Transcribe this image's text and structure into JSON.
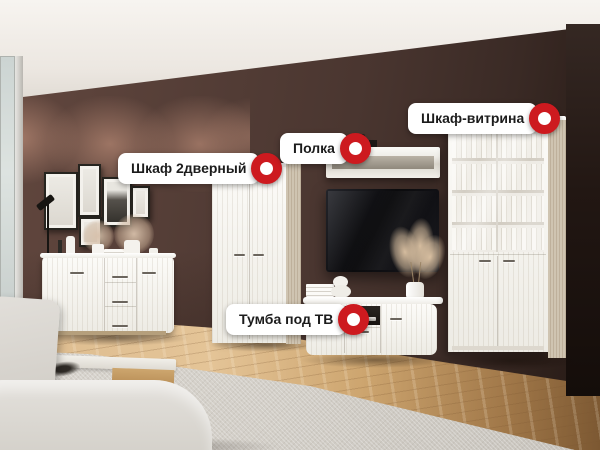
{
  "callouts": [
    {
      "id": "wardrobe-2door",
      "label": "Шкаф 2дверный"
    },
    {
      "id": "shelf",
      "label": "Полка"
    },
    {
      "id": "display-cabinet",
      "label": "Шкаф-витрина"
    },
    {
      "id": "tv-stand",
      "label": "Тумба под ТВ"
    }
  ],
  "style": {
    "marker_accent": "#cd1a1f",
    "pill_background": "#ffffff",
    "pill_text_color": "#1c1c1c"
  },
  "scene": {
    "items": [
      "chest-of-drawers",
      "gallery-frames",
      "floor-lamp",
      "wardrobe-2door",
      "wall-shelf",
      "tv",
      "tv-stand",
      "display-cabinet",
      "sofa",
      "coffee-table",
      "rug",
      "balcony-door"
    ]
  }
}
